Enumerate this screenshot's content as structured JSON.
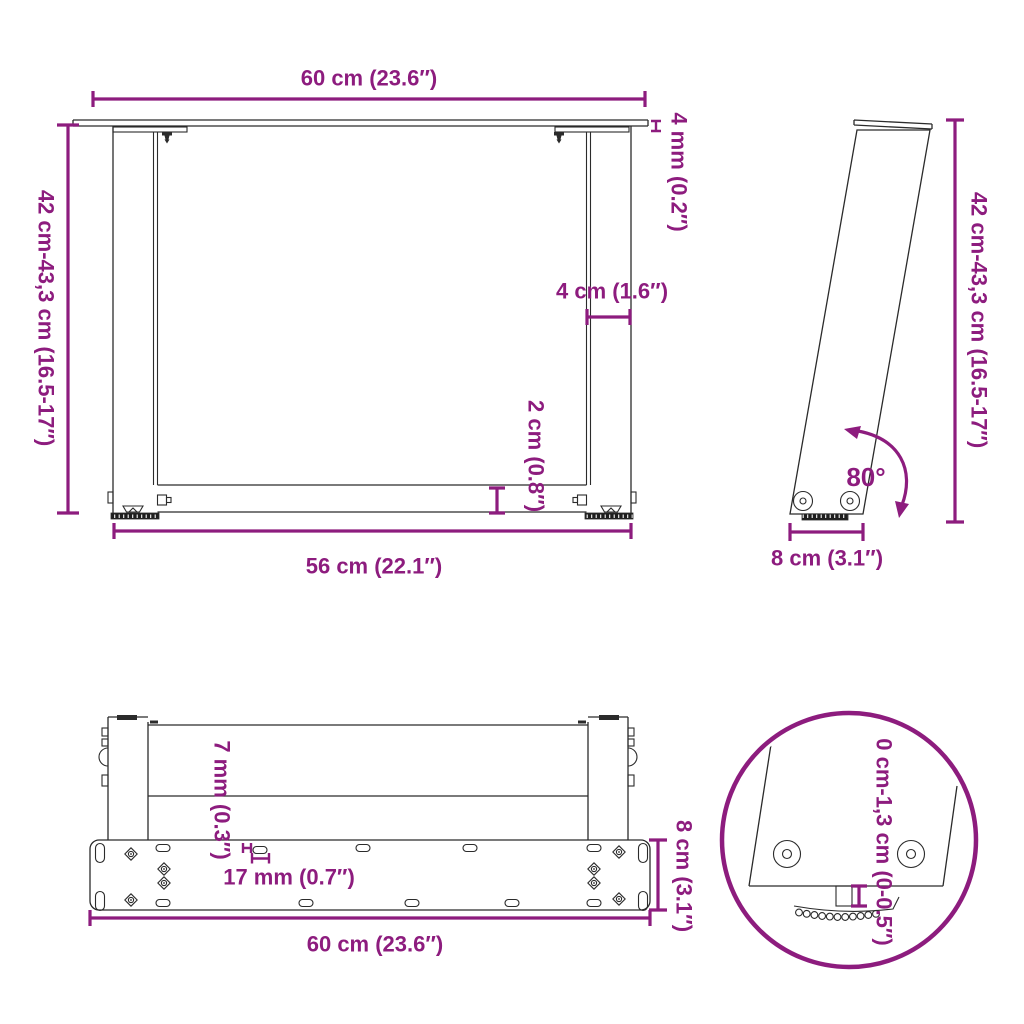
{
  "colors": {
    "accent": "#8D1C7E",
    "line": "#2B2B2B",
    "background": "#FFFFFF"
  },
  "views": {
    "front": {
      "dims": {
        "top_width": "60 cm (23.6″)",
        "height": "42 cm-43,3 cm (16.5-17″)",
        "top_thickness": "4 mm (0.2″)",
        "leg_width": "4 cm (1.6″)",
        "crossbar": "2 cm (0.8″)",
        "inner_width": "56 cm (22.1″)"
      }
    },
    "side": {
      "dims": {
        "height": "42 cm-43,3 cm (16.5-17″)",
        "angle": "80°",
        "base_depth": "8 cm (3.1″)"
      }
    },
    "bottom": {
      "dims": {
        "hole_offset": "7 mm (0.3″)",
        "slot_length": "17 mm (0.7″)",
        "plate_depth": "8 cm (3.1″)",
        "width": "60 cm (23.6″)"
      }
    },
    "detail": {
      "dims": {
        "foot_adjustment": "0 cm-1,3 cm (0-0.5″)"
      }
    }
  }
}
